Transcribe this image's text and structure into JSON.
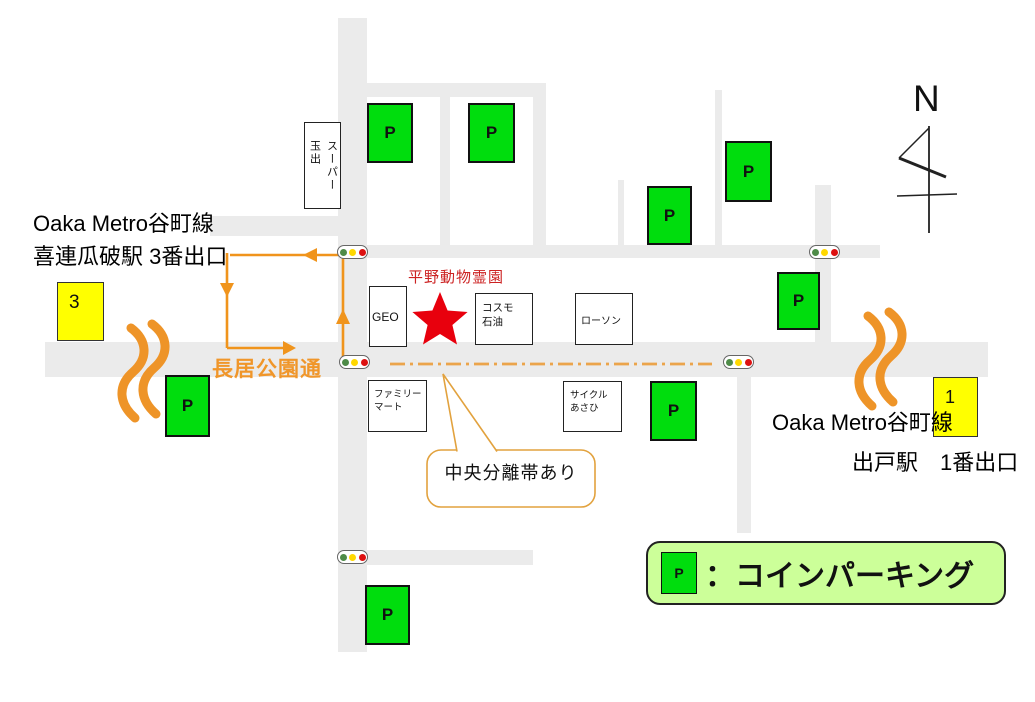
{
  "compass": {
    "label": "N"
  },
  "stations": {
    "left": {
      "line1": "Oaka Metro谷町線",
      "line2": "喜連瓜破駅 3番出口",
      "exit_number": "3"
    },
    "right": {
      "line1": "Oaka Metro谷町線",
      "line2": "出戸駅　1番出口",
      "exit_number": "1"
    }
  },
  "destination": {
    "name": "平野動物霊園"
  },
  "road_label": "長居公園通",
  "callout": {
    "text": "中央分離帯あり"
  },
  "legend": {
    "symbol": "P",
    "text": "：コインパーキング"
  },
  "parking": {
    "symbol": "P"
  },
  "landmarks": {
    "super_tamade": "スーパー玉出",
    "geo": "GEO",
    "cosmo": "コスモ\n石油",
    "lawson": "ローソン",
    "familymart": "ファミリー\nマート",
    "cycle_asahi": "サイクル\nあさひ"
  },
  "colors": {
    "road": "#ebebeb",
    "parking_green": "#00dd0d",
    "station_yellow": "#ffff00",
    "route_orange": "#f0941c",
    "destination_red": "#e8000d",
    "legend_bg": "#ccff99"
  }
}
